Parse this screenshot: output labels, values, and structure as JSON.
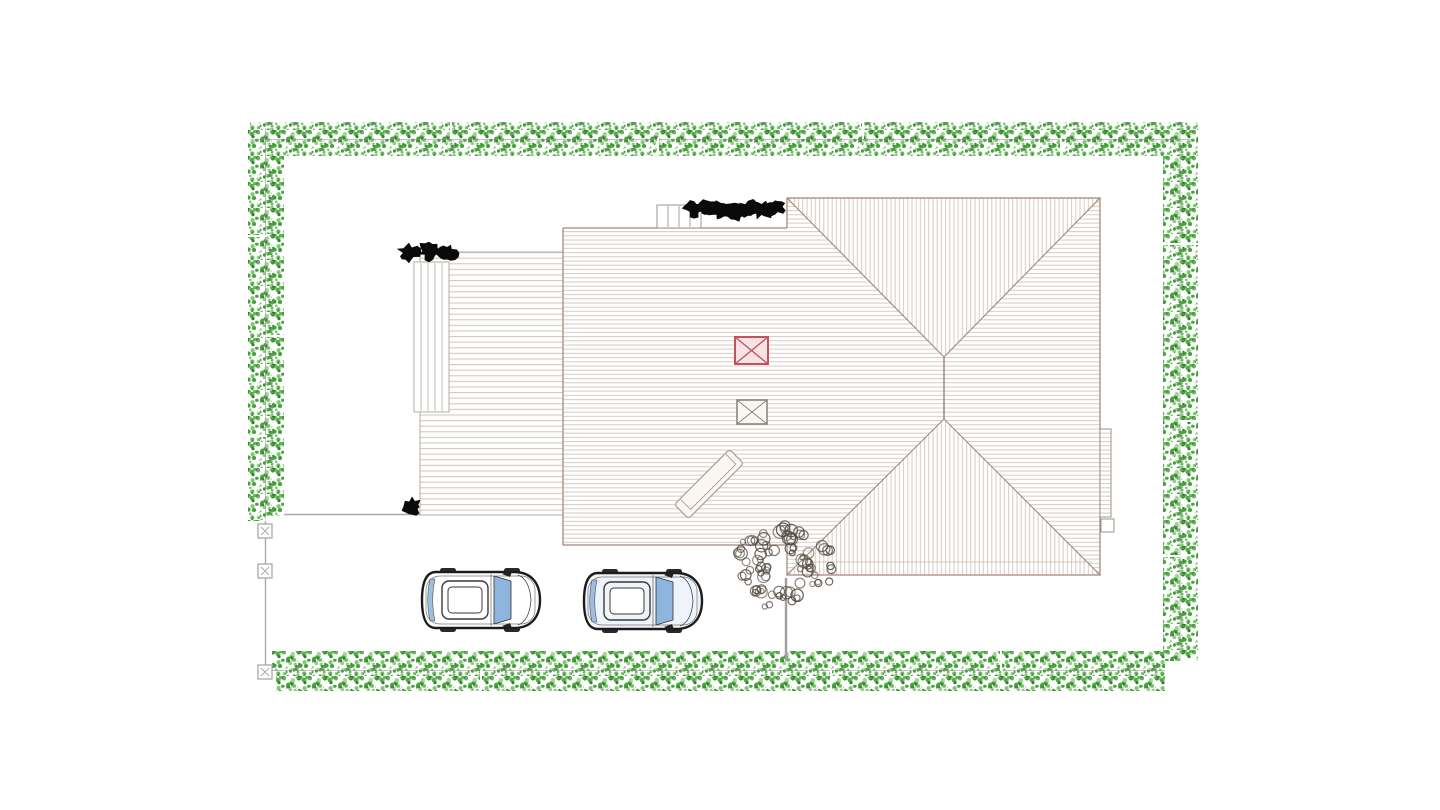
{
  "document": {
    "kind": "architectural-site-plan-drawing",
    "visible_text": [],
    "background": "#ffffff"
  },
  "colors": {
    "hedge_greens": [
      "#44a038",
      "#2f7f27",
      "#66b95a",
      "#98d28b"
    ],
    "hedge_line": "#8f8f8f",
    "roof_hatch": "#d5c8c0",
    "roof_edge": "#a1887a",
    "deck_line": "#cdc5bb",
    "deck_edge": "#b3ada3",
    "gray_edge": "#9b968e",
    "fence": "#a9a9a9",
    "fence_light": "#bdbdbd",
    "red_box_edge": "#c4515c",
    "red_box_fill": "#f7e3e4",
    "gray_box_edge": "#8d857b",
    "gray_box_fill": "#f8f6f2",
    "ramp_edge": "#ab9c8e",
    "ramp_fill": "#faf7f3",
    "glass": "#8db5dd",
    "car_outline": "#1c1c1c",
    "car2_body": "#eef4fa",
    "plant_black": "#0a0a0a",
    "tree_stroke": "#544a40",
    "trunk": "#9f9f9f"
  },
  "elements": {
    "boundary_hedge": {
      "shape": "rectangular-perimeter",
      "sides": [
        "top",
        "left",
        "right",
        "bottom"
      ],
      "style": "speckled-green-bushes"
    },
    "building": {
      "left_section_roof": "horizontal-hatch",
      "right_section_roof": "hip-roof-with-ridge",
      "markers": [
        "red-crossed-square",
        "gray-crossed-square"
      ],
      "features": [
        "top-steps",
        "roof-ramp",
        "right-side-protrusion"
      ]
    },
    "deck": {
      "pattern": "horizontal-plank-lines",
      "features": [
        "stair-strip"
      ]
    },
    "cars": {
      "count": 2,
      "view": "top-down",
      "facing": "right"
    },
    "tree": {
      "count": 1,
      "style": "scribbled-canopy-with-trunk"
    },
    "shrub_clusters": {
      "count": 3,
      "style": "solid-black-scribble"
    },
    "fence": {
      "post_count": 3,
      "post_style": "square-with-x"
    }
  }
}
